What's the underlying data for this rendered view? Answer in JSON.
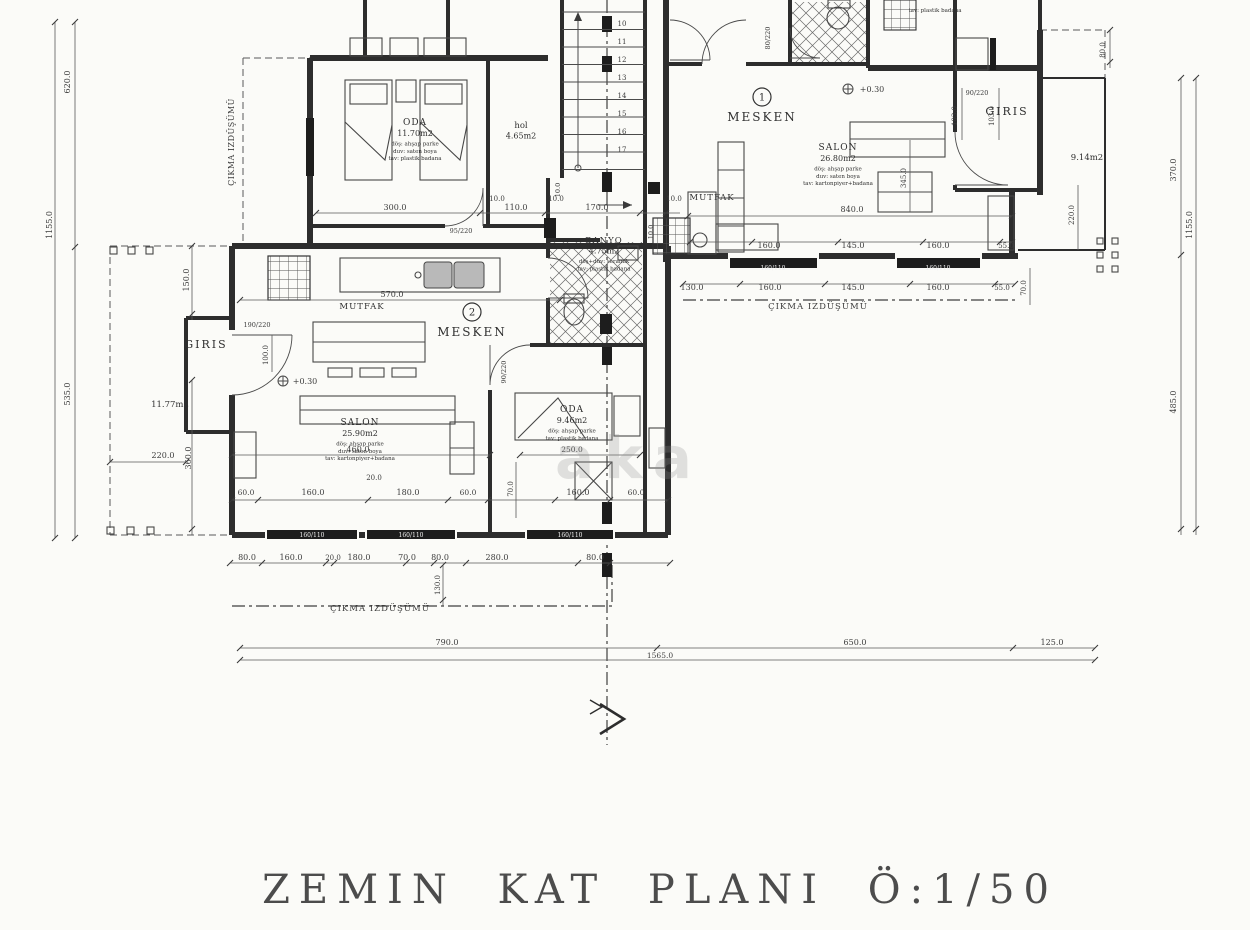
{
  "title": "ZEMIN KAT PLANI Ö:1/50",
  "watermark": "aka",
  "unit_badges": [
    {
      "n": "1",
      "x": 762,
      "y": 97,
      "label": "MESKEN",
      "lx": 762,
      "ly": 121
    },
    {
      "n": "2",
      "x": 472,
      "y": 312,
      "label": "MESKEN",
      "lx": 472,
      "ly": 336
    }
  ],
  "stairs": {
    "numbers": [
      "10",
      "11",
      "12",
      "13",
      "14",
      "15",
      "16",
      "17"
    ]
  },
  "room_labels": [
    {
      "x": 415,
      "y": 125,
      "lines": [
        {
          "t": "ODA",
          "s": 9,
          "ls": 1
        },
        {
          "t": "11.70m2",
          "s": 8
        },
        {
          "t": "döş: ahşap parke",
          "s": 5.5
        },
        {
          "t": "duv: saten boya",
          "s": 5.5
        },
        {
          "t": "tav: plastik badana",
          "s": 5.5
        }
      ]
    },
    {
      "x": 521,
      "y": 128,
      "lines": [
        {
          "t": "hol",
          "s": 8.5
        },
        {
          "t": "4.65m2",
          "s": 8
        }
      ]
    },
    {
      "x": 838,
      "y": 150,
      "lines": [
        {
          "t": "SALON",
          "s": 9,
          "ls": 1
        },
        {
          "t": "26.80m2",
          "s": 8
        },
        {
          "t": "döş: ahşap parke",
          "s": 5.5
        },
        {
          "t": "duv: saten boya",
          "s": 5.5
        },
        {
          "t": "tav: kartonpiyer+badana",
          "s": 5.5
        }
      ]
    },
    {
      "x": 712,
      "y": 200,
      "lines": [
        {
          "t": "MUTFAK",
          "s": 8.5,
          "ls": 1
        }
      ]
    },
    {
      "x": 1007,
      "y": 115,
      "lines": [
        {
          "t": "GIRIS",
          "s": 11,
          "ls": 2
        }
      ]
    },
    {
      "x": 1087,
      "y": 160,
      "lines": [
        {
          "t": "9.14m2",
          "s": 8.5
        }
      ]
    },
    {
      "x": 604,
      "y": 243,
      "lines": [
        {
          "t": "BANYO",
          "s": 8.5,
          "ls": 1
        },
        {
          "t": "4.75m2",
          "s": 8
        },
        {
          "t": "döş+duv: seramik",
          "s": 5.5
        },
        {
          "t": "tav: plastik badana",
          "s": 5.5
        }
      ]
    },
    {
      "x": 362,
      "y": 309,
      "lines": [
        {
          "t": "MUTFAK",
          "s": 8.5,
          "ls": 1
        }
      ]
    },
    {
      "x": 206,
      "y": 348,
      "lines": [
        {
          "t": "GIRIS",
          "s": 11,
          "ls": 2
        }
      ]
    },
    {
      "x": 170,
      "y": 407,
      "lines": [
        {
          "t": "11.77m2",
          "s": 8.5
        }
      ]
    },
    {
      "x": 360,
      "y": 425,
      "lines": [
        {
          "t": "SALON",
          "s": 9,
          "ls": 1
        },
        {
          "t": "25.90m2",
          "s": 8
        },
        {
          "t": "döş: ahşap parke",
          "s": 5.5
        },
        {
          "t": "duv: saten boya",
          "s": 5.5
        },
        {
          "t": "tav: kartonpiyer+badana",
          "s": 5.5
        }
      ]
    },
    {
      "x": 572,
      "y": 412,
      "lines": [
        {
          "t": "ODA",
          "s": 9,
          "ls": 1
        },
        {
          "t": "9.46m2",
          "s": 8
        },
        {
          "t": "döş: ahşap parke",
          "s": 5.5
        },
        {
          "t": "tav: plastik badana",
          "s": 5.5
        }
      ]
    },
    {
      "x": 935,
      "y": 12,
      "lines": [
        {
          "t": "tav: plastik badana",
          "s": 5.5
        }
      ]
    }
  ],
  "dim_labels": [
    {
      "t": "300.0",
      "x": 395,
      "y": 210
    },
    {
      "t": "10.0",
      "x": 497,
      "y": 201,
      "s": 7
    },
    {
      "t": "110.0",
      "x": 516,
      "y": 210
    },
    {
      "t": "10.0",
      "x": 556,
      "y": 201,
      "s": 7
    },
    {
      "t": "170.0",
      "x": 597,
      "y": 210
    },
    {
      "t": "10.0",
      "x": 674,
      "y": 201,
      "s": 7
    },
    {
      "t": "840.0",
      "x": 852,
      "y": 212
    },
    {
      "t": "345.0",
      "x": 906,
      "y": 178,
      "r": 1,
      "s": 7
    },
    {
      "t": "160.0",
      "x": 769,
      "y": 248
    },
    {
      "t": "145.0",
      "x": 853,
      "y": 248
    },
    {
      "t": "160.0",
      "x": 938,
      "y": 248
    },
    {
      "t": "55.0",
      "x": 1006,
      "y": 248,
      "s": 7
    },
    {
      "t": "130.0",
      "x": 692,
      "y": 290
    },
    {
      "t": "160.0",
      "x": 770,
      "y": 290
    },
    {
      "t": "145.0",
      "x": 853,
      "y": 290
    },
    {
      "t": "160.0",
      "x": 938,
      "y": 290
    },
    {
      "t": "55.0",
      "x": 1002,
      "y": 290,
      "s": 7
    },
    {
      "t": "ÇIKMA IZDÜŞÜMÜ",
      "x": 818,
      "y": 309,
      "s": 8.5,
      "sp": 1
    },
    {
      "t": "70.0",
      "x": 1026,
      "y": 288,
      "r": 1,
      "s": 7
    },
    {
      "t": "570.0",
      "x": 392,
      "y": 297
    },
    {
      "t": "190/220",
      "x": 257,
      "y": 327,
      "s": 6.5
    },
    {
      "t": "95/220",
      "x": 461,
      "y": 233,
      "s": 6.5
    },
    {
      "t": "90/220",
      "x": 977,
      "y": 95,
      "s": 6.5
    },
    {
      "t": "80/220",
      "x": 770,
      "y": 38,
      "r": 1,
      "s": 6.5
    },
    {
      "t": "90/220",
      "x": 506,
      "y": 372,
      "r": 1,
      "s": 6.5
    },
    {
      "t": "100.0",
      "x": 268,
      "y": 355,
      "r": 1,
      "s": 7
    },
    {
      "t": "150.0",
      "x": 189,
      "y": 280,
      "r": 1
    },
    {
      "t": "360.0",
      "x": 191,
      "y": 458,
      "r": 1
    },
    {
      "t": "220.0",
      "x": 163,
      "y": 458
    },
    {
      "t": "460.0",
      "x": 358,
      "y": 452
    },
    {
      "t": "20.0",
      "x": 374,
      "y": 480,
      "s": 7
    },
    {
      "t": "250.0",
      "x": 572,
      "y": 452,
      "s": 7.5
    },
    {
      "t": "60.0",
      "x": 246,
      "y": 495,
      "s": 7.5
    },
    {
      "t": "160.0",
      "x": 313,
      "y": 495
    },
    {
      "t": "180.0",
      "x": 408,
      "y": 495
    },
    {
      "t": "60.0",
      "x": 468,
      "y": 495,
      "s": 7.5
    },
    {
      "t": "70.0",
      "x": 513,
      "y": 489,
      "r": 1,
      "s": 7
    },
    {
      "t": "160.0",
      "x": 578,
      "y": 495
    },
    {
      "t": "60.0",
      "x": 636,
      "y": 495,
      "s": 7.5
    },
    {
      "t": "80.0",
      "x": 247,
      "y": 560
    },
    {
      "t": "160.0",
      "x": 291,
      "y": 560
    },
    {
      "t": "20.0",
      "x": 333,
      "y": 560,
      "s": 7
    },
    {
      "t": "180.0",
      "x": 359,
      "y": 560
    },
    {
      "t": "70.0",
      "x": 407,
      "y": 560
    },
    {
      "t": "80.0",
      "x": 440,
      "y": 560
    },
    {
      "t": "280.0",
      "x": 497,
      "y": 560
    },
    {
      "t": "80.0",
      "x": 595,
      "y": 560
    },
    {
      "t": "130.0",
      "x": 440,
      "y": 585,
      "r": 1,
      "s": 7
    },
    {
      "t": "ÇIKMA IZDÜŞÜMÜ",
      "x": 380,
      "y": 611,
      "s": 8.5,
      "sp": 1
    },
    {
      "t": "790.0",
      "x": 447,
      "y": 645
    },
    {
      "t": "650.0",
      "x": 855,
      "y": 645
    },
    {
      "t": "125.0",
      "x": 1052,
      "y": 645
    },
    {
      "t": "1565.0",
      "x": 660,
      "y": 658,
      "s": 7.5
    },
    {
      "t": "620.0",
      "x": 70,
      "y": 82,
      "r": 1
    },
    {
      "t": "1155.0",
      "x": 52,
      "y": 225,
      "r": 1
    },
    {
      "t": "535.0",
      "x": 70,
      "y": 394,
      "r": 1
    },
    {
      "t": "ÇIKMA IZDÜŞÜMÜ",
      "x": 234,
      "y": 142,
      "r": 1,
      "s": 8,
      "sp": 0.5
    },
    {
      "t": "80.0",
      "x": 1105,
      "y": 50,
      "r": 1,
      "s": 7
    },
    {
      "t": "370.0",
      "x": 1176,
      "y": 170,
      "r": 1
    },
    {
      "t": "485.0",
      "x": 1176,
      "y": 402,
      "r": 1
    },
    {
      "t": "1155.0",
      "x": 1192,
      "y": 225,
      "r": 1
    },
    {
      "t": "103.0",
      "x": 957,
      "y": 116,
      "r": 1,
      "s": 7
    },
    {
      "t": "103.0",
      "x": 994,
      "y": 116,
      "r": 1,
      "s": 7
    },
    {
      "t": "220.0",
      "x": 1074,
      "y": 215,
      "r": 1,
      "s": 7
    },
    {
      "t": "160/110",
      "x": 773,
      "y": 270,
      "s": 6,
      "w": 1
    },
    {
      "t": "160/110",
      "x": 938,
      "y": 270,
      "s": 6,
      "w": 1
    },
    {
      "t": "160/110",
      "x": 312,
      "y": 537,
      "s": 6,
      "w": 1
    },
    {
      "t": "160/110",
      "x": 411,
      "y": 537,
      "s": 6,
      "w": 1
    },
    {
      "t": "160/110",
      "x": 570,
      "y": 537,
      "s": 6,
      "w": 1
    },
    {
      "t": "+0.30",
      "x": 305,
      "y": 384,
      "s": 8
    },
    {
      "t": "+0.30",
      "x": 872,
      "y": 92,
      "s": 8
    },
    {
      "t": "10.0",
      "x": 560,
      "y": 190,
      "r": 1,
      "s": 6.5
    },
    {
      "t": "10.0",
      "x": 653,
      "y": 232,
      "r": 1,
      "s": 6.5
    }
  ]
}
